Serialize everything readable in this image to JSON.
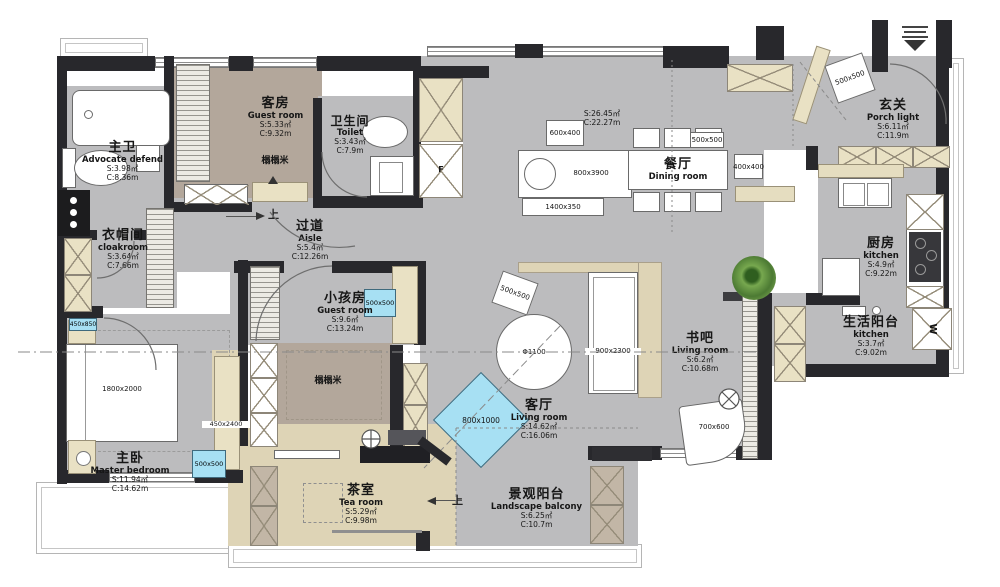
{
  "rooms": {
    "master_bath": {
      "cn": "主卫",
      "en": "Advocate defend",
      "s": "S:3.98㎡",
      "c": "C:8.36m"
    },
    "guest_room": {
      "cn": "客房",
      "en": "Guest room",
      "s": "S:5.33㎡",
      "c": "C:9.32m"
    },
    "toilet": {
      "cn": "卫生间",
      "en": "Toilet",
      "s": "S:3.43㎡",
      "c": "C:7.9m"
    },
    "aisle": {
      "cn": "过道",
      "en": "Aisle",
      "s": "S:5.4㎡",
      "c": "C:12.26m"
    },
    "cloakroom": {
      "cn": "衣帽间",
      "en": "cloakroom",
      "s": "S:3.64㎡",
      "c": "C:7.66m"
    },
    "dining": {
      "cn": "餐厅",
      "en": "Dining room",
      "s": "S:26.45㎡",
      "c": "C:22.27m"
    },
    "porch": {
      "cn": "玄关",
      "en": "Porch light",
      "s": "S:6.11㎡",
      "c": "C:11.9m"
    },
    "kitchen": {
      "cn": "厨房",
      "en": "kitchen",
      "s": "S:4.9㎡",
      "c": "C:9.22m"
    },
    "living_balcony": {
      "cn": "生活阳台",
      "en": "kitchen",
      "s": "S:3.7㎡",
      "c": "C:9.02m"
    },
    "kids_room": {
      "cn": "小孩房",
      "en": "Guest room",
      "s": "S:9.6㎡",
      "c": "C:13.24m"
    },
    "book_bar": {
      "cn": "书吧",
      "en": "Living room",
      "s": "S:6.2㎡",
      "c": "C:10.68m"
    },
    "living_room": {
      "cn": "客厅",
      "en": "Living room",
      "s": "S:14.62㎡",
      "c": "C:16.06m"
    },
    "master_bedroom": {
      "cn": "主卧",
      "en": "Master bedroom",
      "s": "S:11.94㎡",
      "c": "C:14.62m"
    },
    "tea_room": {
      "cn": "茶室",
      "en": "Tea room",
      "s": "S:5.29㎡",
      "c": "C:9.98m"
    },
    "landscape_balcony": {
      "cn": "景观阳台",
      "en": "Landscape balcony",
      "s": "S:6.25㎡",
      "c": "C:10.7m"
    }
  },
  "dims": {
    "buffet": "600x400",
    "island": "800x3900",
    "console": "1400x350",
    "dining_chair": "500x500",
    "dining_side": "400x400",
    "porch_stool": "500x500",
    "living_stool": "500x500",
    "round_table": "Φ1100",
    "rug": "900x2300",
    "armchair": "700x600",
    "blue_table": "800x1000",
    "kids_cube": "500x500",
    "master_cube": "500x500",
    "nightstand": "450x850",
    "wardrobe": "450x2400",
    "bed": "1800x2000"
  },
  "annotations": {
    "tatami": "榻榻米",
    "up": "上",
    "washer": "W",
    "fridge": "F"
  },
  "colors": {
    "wall": "#28282c",
    "floor": "#bcbcbe",
    "tatami": "#b3a79b",
    "wood": "#ded4b6",
    "cabinet": "#e9e1c4",
    "accent_blue": "#a7e0f3"
  }
}
